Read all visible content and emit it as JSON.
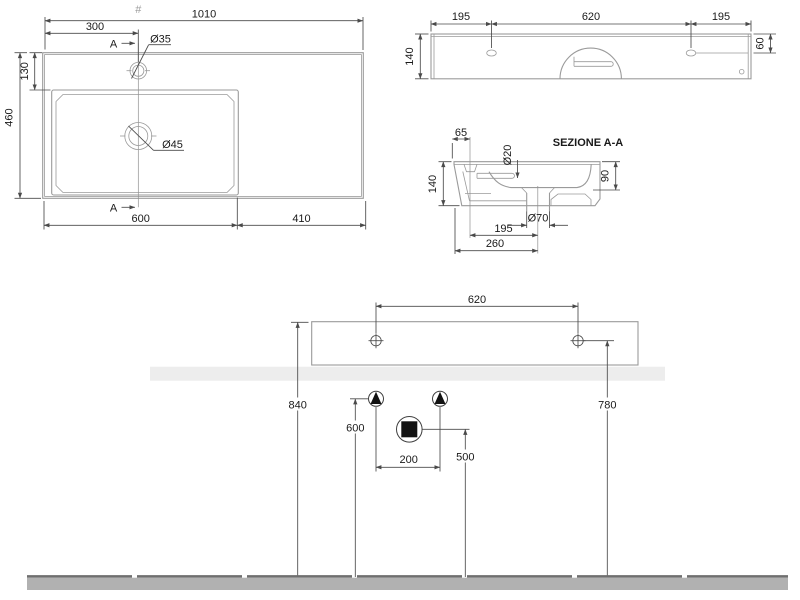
{
  "meta": {
    "centerline_mark": "#"
  },
  "plan_view": {
    "overall_width": "1010",
    "faucet_offset": "300",
    "faucet_diameter": "Ø35",
    "deck_depth": "130",
    "overall_depth": "460",
    "drain_diameter": "Ø45",
    "basin_width": "600",
    "shelf_width": "410",
    "section_marker_top": "A",
    "section_marker_bottom": "A"
  },
  "rear_view": {
    "left_hole_offset": "195",
    "hole_spacing": "620",
    "right_hole_offset": "195",
    "height": "140",
    "hole_top_offset": "60"
  },
  "section_view": {
    "title": "SEZIONE A-A",
    "faucet_back_offset": "65",
    "overflow_diameter": "Ø20",
    "height": "140",
    "bowl_depth": "90",
    "drain_diameter": "Ø70",
    "faucet_to_drain": "195",
    "back_to_drain": "260"
  },
  "installation_view": {
    "hole_spacing": "620",
    "rim_height": "840",
    "hole_height": "780",
    "supply_height": "600",
    "drain_height": "500",
    "supply_spacing": "200"
  },
  "colors": {
    "outline": "#9a9a9a",
    "dim": "#4a4a4a",
    "text": "#1a1a1a",
    "wall_band": "#ededed",
    "floor_band": "#b1b1b1",
    "floor_edge": "#6f6f6f",
    "symbol": "#111111"
  }
}
